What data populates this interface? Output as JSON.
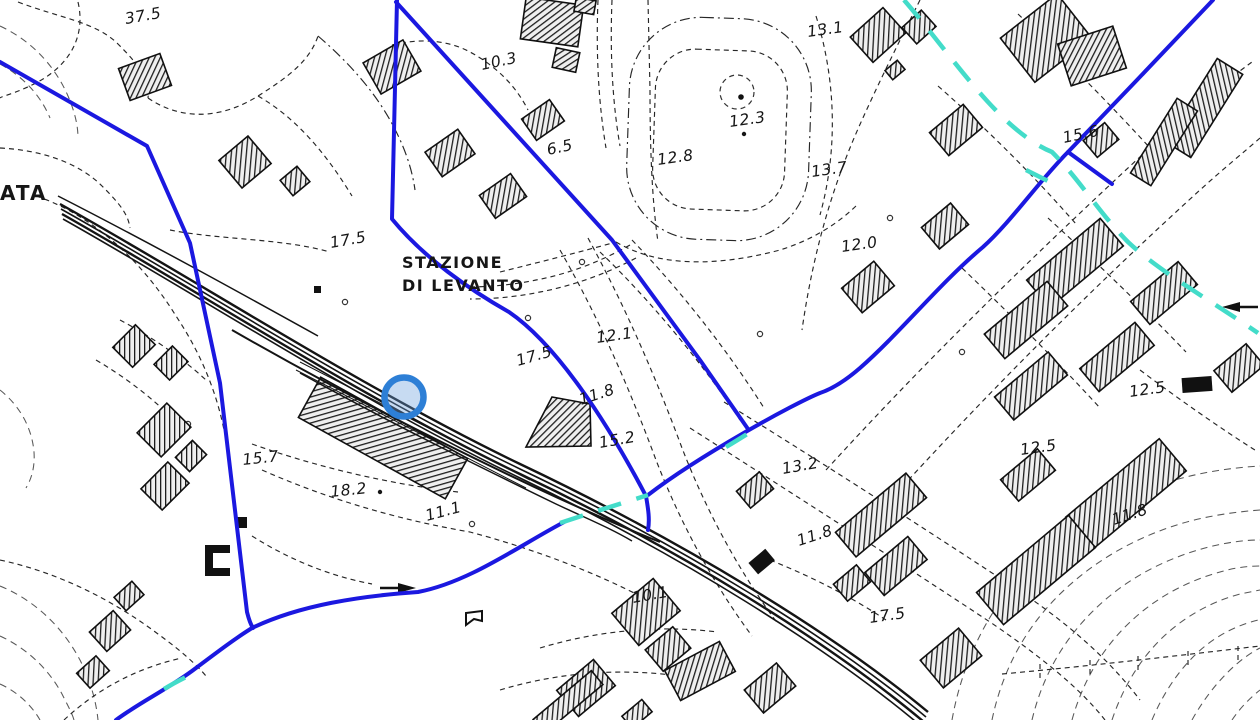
{
  "map": {
    "labels": {
      "station_line1": "STAZIONE",
      "station_line2": "DI LEVANTO",
      "edge_text": "ATA"
    },
    "spot_heights": [
      "37.5",
      "10.3",
      "6.5",
      "12.8",
      "12.3",
      "13.1",
      "13.7",
      "15.6",
      "12.0",
      "17.5",
      "12.1",
      "17.5",
      "11.8",
      "15.2",
      "13.2",
      "11.8",
      "12.5",
      "12.5",
      "11.8",
      "17.5",
      "10.1",
      "18.2",
      "15.7",
      "11.1"
    ],
    "symbols": {
      "selected_location_marker": "blue-hatched-circle"
    },
    "colors": {
      "background": "#ffffff",
      "ink": "#161616",
      "utility_line_blue": "#1b18e0",
      "aqueduct_cyan": "#43dcc9",
      "marker_blue": "#2d7fd6",
      "marker_fill": "rgba(108,160,220,0.38)"
    }
  }
}
